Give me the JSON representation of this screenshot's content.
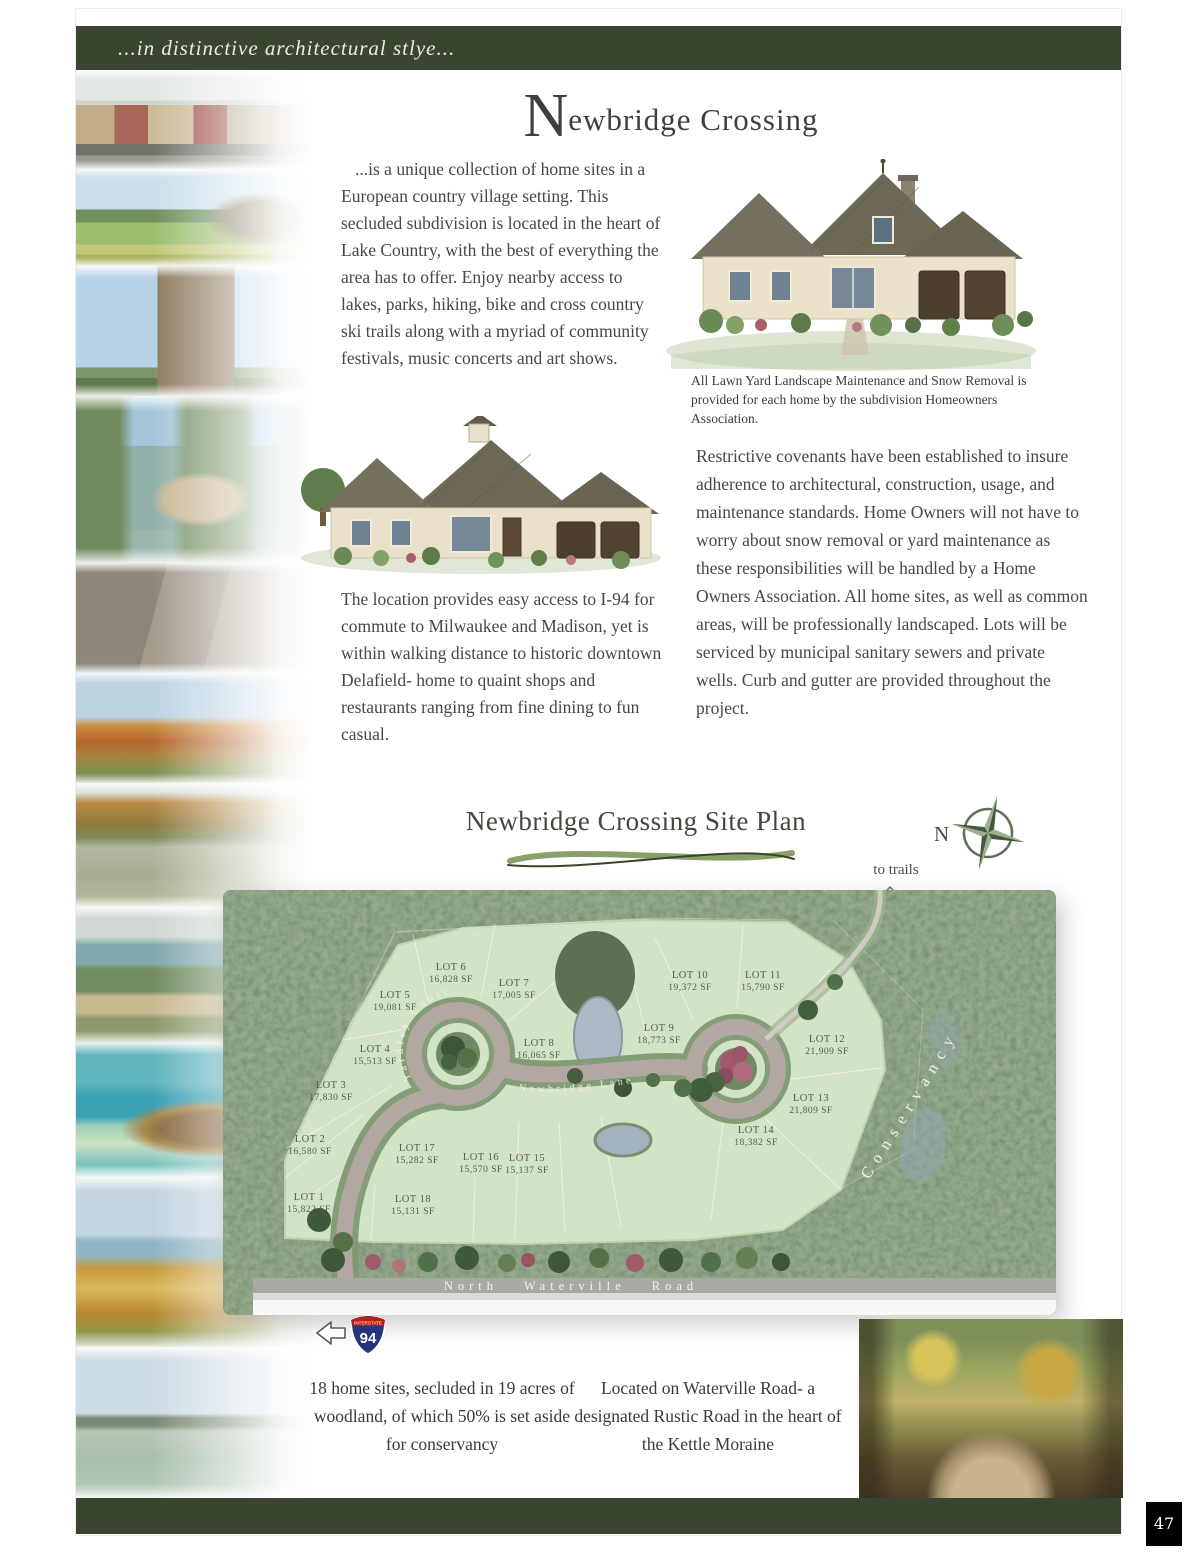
{
  "page": {
    "header_tagline": "...in distinctive architectural stlye...",
    "title_initial": "N",
    "title_rest": "ewbridge Crossing",
    "page_number": "47"
  },
  "paragraphs": {
    "intro": "...is a unique collection of home sites in a European country village setting. This secluded subdivision is located in the heart of Lake Country, with the best of everything the area has to offer. Enjoy nearby access to lakes, parks, hiking, bike and cross country ski trails along with a myriad of community festivals, music concerts and art shows.",
    "maintenance_caption": "All Lawn Yard Landscape Maintenance and Snow Removal is provided for each home by the subdivision Homeowners Association.",
    "covenants": "Restrictive covenants have been established to insure adherence to architectural, construction, usage, and maintenance standards. Home Owners will not have to worry about snow removal or yard maintenance as these responsibilities will be handled by a Home Owners Association. All home sites, as well as common areas, will be professionally landscaped. Lots will be serviced by municipal sanitary sewers and private wells. Curb and gutter are provided throughout the project.",
    "location": "The location provides easy access to I-94 for commute to Milwaukee and Madison, yet is within walking distance to historic downtown Delafield- home to quaint shops and restaurants ranging from fine dining to fun casual."
  },
  "site_plan": {
    "title": "Newbridge Crossing Site Plan",
    "compass_label": "N",
    "trails_label": "to trails",
    "conservancy_label": "Conservancy",
    "road_label": "North Waterville Road",
    "street_yardley": "Yardley Court",
    "street_newbridge": "Newbridge Lane",
    "interstate_top": "INTERSTATE",
    "interstate_number": "94",
    "lots": [
      {
        "name": "LOT 1",
        "sf": "15,822 SF",
        "x": 86,
        "y": 310
      },
      {
        "name": "LOT 2",
        "sf": "16,580 SF",
        "x": 87,
        "y": 252
      },
      {
        "name": "LOT 3",
        "sf": "17,830 SF",
        "x": 108,
        "y": 198
      },
      {
        "name": "LOT 4",
        "sf": "15,513 SF",
        "x": 152,
        "y": 162
      },
      {
        "name": "LOT 5",
        "sf": "19,081 SF",
        "x": 172,
        "y": 108
      },
      {
        "name": "LOT 6",
        "sf": "16,828 SF",
        "x": 228,
        "y": 80
      },
      {
        "name": "LOT 7",
        "sf": "17,005 SF",
        "x": 291,
        "y": 96
      },
      {
        "name": "LOT 8",
        "sf": "16,065 SF",
        "x": 316,
        "y": 156
      },
      {
        "name": "LOT 9",
        "sf": "18,773 SF",
        "x": 436,
        "y": 141
      },
      {
        "name": "LOT 10",
        "sf": "19,372 SF",
        "x": 467,
        "y": 88
      },
      {
        "name": "LOT 11",
        "sf": "15,790 SF",
        "x": 540,
        "y": 88
      },
      {
        "name": "LOT 12",
        "sf": "21,909 SF",
        "x": 604,
        "y": 152
      },
      {
        "name": "LOT 13",
        "sf": "21,809 SF",
        "x": 588,
        "y": 211
      },
      {
        "name": "LOT 14",
        "sf": "18,382 SF",
        "x": 533,
        "y": 243
      },
      {
        "name": "LOT 15",
        "sf": "15,137 SF",
        "x": 304,
        "y": 271
      },
      {
        "name": "LOT 16",
        "sf": "15,570 SF",
        "x": 258,
        "y": 270
      },
      {
        "name": "LOT 17",
        "sf": "15,282 SF",
        "x": 194,
        "y": 261
      },
      {
        "name": "LOT 18",
        "sf": "15,131 SF",
        "x": 190,
        "y": 312
      }
    ]
  },
  "footer": {
    "summary_left": "18 home sites, secluded in 19 acres of woodland, of which 50% is set aside for conservancy",
    "summary_right": "Located on Waterville Road- a designated Rustic Road in the heart of the Kettle Moraine"
  },
  "colors": {
    "header_bar": "#3a4531",
    "footer_bar": "#3a4531",
    "forest_green": "#4e6147",
    "lot_green": "#d3e4c6",
    "swoosh_green": "#8aa06a",
    "compass_green": "#5c7156",
    "interstate_red": "#b0201f",
    "interstate_blue": "#27347d"
  }
}
